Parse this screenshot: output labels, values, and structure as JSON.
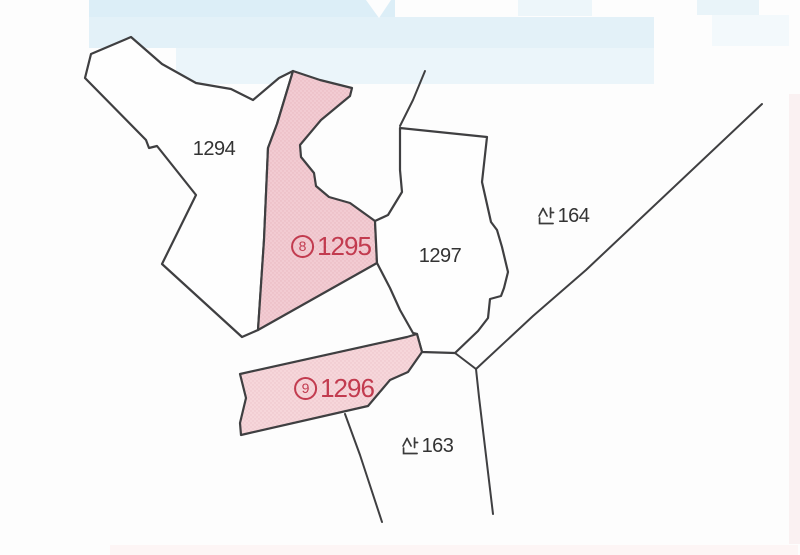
{
  "map": {
    "kind": "cadastral-parcel-map",
    "colors": {
      "line": "#3f3f41",
      "water_tint": "#e3f1f8",
      "highlight_fill_1295": "#f2cbd2",
      "highlight_fill_1296": "#f6d6da",
      "highlight_text": "#c23b4f",
      "parcel_text": "#333333",
      "background": "#fdfdfd"
    },
    "parcels": [
      {
        "id": "1294",
        "label": "1294",
        "type": "plain"
      },
      {
        "id": "1295",
        "label": "⑧1295",
        "circled_number": "8",
        "lot_number": "1295",
        "type": "highlighted"
      },
      {
        "id": "1297",
        "label": "1297",
        "type": "plain"
      },
      {
        "id": "1296",
        "label": "⑨1296",
        "circled_number": "9",
        "lot_number": "1296",
        "type": "highlighted"
      },
      {
        "id": "san164",
        "label": "산164",
        "hangul_prefix": "산",
        "lot_number": "164",
        "type": "mountain"
      },
      {
        "id": "san163",
        "label": "산163",
        "hangul_prefix": "산",
        "lot_number": "163",
        "type": "mountain"
      }
    ]
  }
}
